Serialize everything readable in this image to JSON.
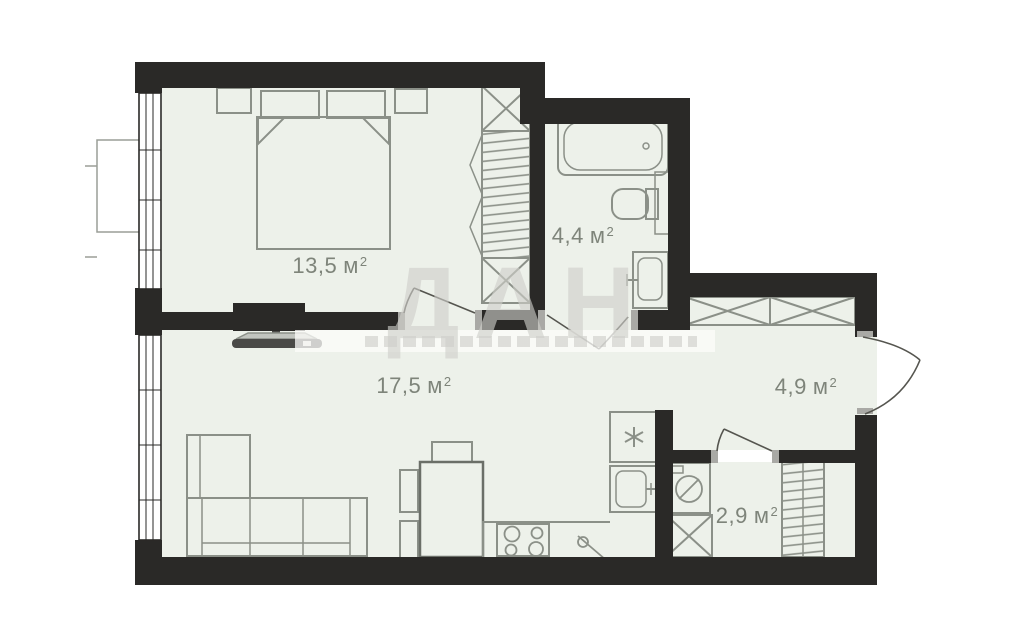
{
  "watermark": {
    "text": "ДАН"
  },
  "rooms": [
    {
      "id": "bedroom",
      "area": "13,5",
      "unit": "м",
      "sup": "2"
    },
    {
      "id": "bathroom",
      "area": "4,4",
      "unit": "м",
      "sup": "2"
    },
    {
      "id": "living-kitchen",
      "area": "17,5",
      "unit": "м",
      "sup": "2"
    },
    {
      "id": "hallway",
      "area": "4,9",
      "unit": "м",
      "sup": "2"
    },
    {
      "id": "storage",
      "area": "2,9",
      "unit": "м",
      "sup": "2"
    }
  ],
  "colors": {
    "wall": "#2a2927",
    "floor": "#edf1ea",
    "furniture_stroke": "#8b9088",
    "label_text": "#7e847a",
    "watermark": "#cfcfca",
    "door_jamb": "#a9a9a5"
  },
  "icons": {
    "fridge": "snowflake-icon",
    "washing_machine": "drum-circle-icon",
    "stove": "four-burners-icon",
    "wardrobe_cells": "x-cross-icon"
  }
}
